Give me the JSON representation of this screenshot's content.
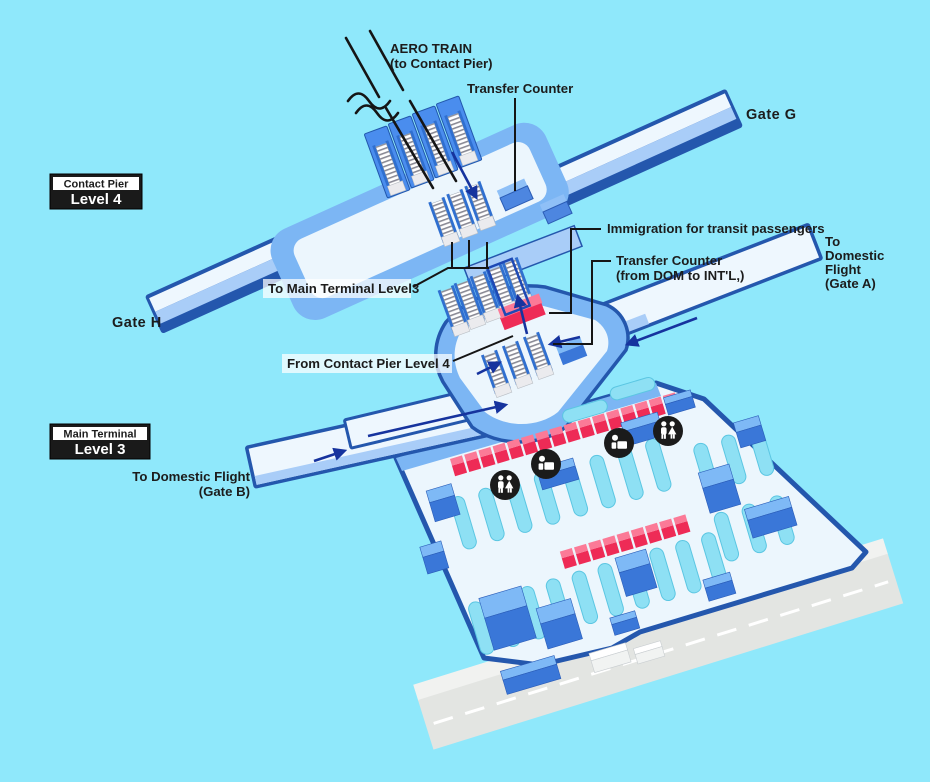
{
  "legend": {
    "contact_pier": {
      "category": "Contact Pier",
      "level": "Level 4"
    },
    "main_terminal": {
      "category": "Main Terminal",
      "level": "Level 3"
    }
  },
  "labels": {
    "aero_train_line1": "AERO TRAIN",
    "aero_train_line2": "(to Contact Pier)",
    "transfer_counter_contact_pier": "Transfer Counter",
    "gate_g": "Gate G",
    "gate_h": "Gate H",
    "to_main_terminal": "To Main Terminal Level3",
    "immigration_transit": "Immigration for transit passengers",
    "transfer_counter_main_line1": "Transfer Counter",
    "transfer_counter_main_line2": "(from DOM to INT'L,)",
    "to_domestic_gate_a_line1": "To",
    "to_domestic_gate_a_line2": "Domestic",
    "to_domestic_gate_a_line3": "Flight",
    "to_domestic_gate_a_line4": "(Gate A)",
    "from_contact_pier": "From Contact Pier Level 4",
    "to_domestic_gate_b_line1": "To Domestic Flight",
    "to_domestic_gate_b_line2": "(Gate B)"
  },
  "icons": {
    "restroom": {
      "name": "restroom-icon",
      "glyph": "two-person-figures",
      "count": 2
    },
    "information_counter": {
      "name": "information-counter-icon",
      "glyph": "person-at-counter",
      "count": 2
    }
  },
  "facilities": {
    "checkin_row_upper_count": 16,
    "checkin_row_lower_count": 9,
    "aero_train_escalator_count": 4,
    "satellite_mid_escalator_count": 3,
    "junction_upper_escalator_count": 5,
    "junction_lower_escalator_count": 3
  },
  "colors": {
    "background": "#8FE8FB",
    "pier_outline": "#2457AD",
    "pier_floor": "#EEF7FE",
    "pier_band": "#A9CDF8",
    "terminal_body": "#7CB6F4",
    "terminal_floor": "#ECF6FD",
    "counter_pink_top": "#FB7A97",
    "counter_pink_front": "#EE2B56",
    "arrow_blue": "#16339E",
    "seat_cyan": "#8EE0F4",
    "box_blue_top": "#7EB9F6",
    "box_blue_front": "#3A77D8",
    "road_gray": "#E3E5E2",
    "label_text": "#1C1C1C"
  }
}
